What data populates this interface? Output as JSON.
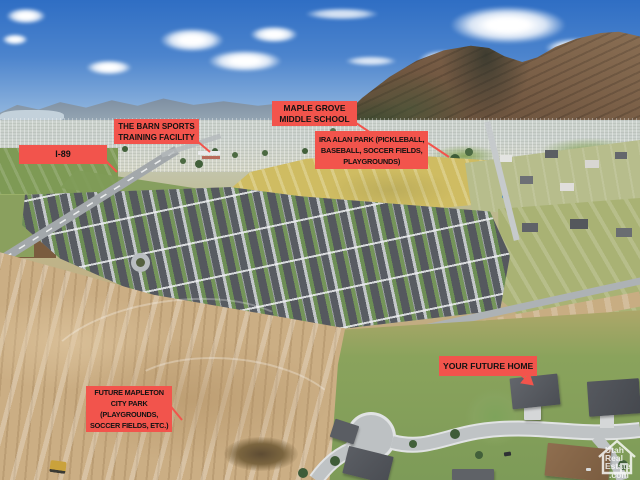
{
  "labels": {
    "i89": "I-89",
    "barn": "THE BARN SPORTS\nTRAINING FACILITY",
    "maple_grove": "MAPLE GROVE\nMIDDLE SCHOOL",
    "ira_alan": "IRA ALAN PARK (PICKLEBALL,\nBASEBALL, SOCCER FIELDS,\nPLAYGROUNDS)",
    "future_home": "YOUR FUTURE HOME",
    "mapleton_park": "FUTURE MAPLETON\nCITY PARK\n(PLAYGROUNDS,\nSOCCER FIELDS, ETC.)"
  },
  "watermark": {
    "lines": [
      "Utah",
      "Real",
      "Estate",
      ".com"
    ]
  },
  "colors": {
    "label_background": "#f2544c",
    "label_text": "#121212",
    "pointer_line": "#f2544c"
  }
}
